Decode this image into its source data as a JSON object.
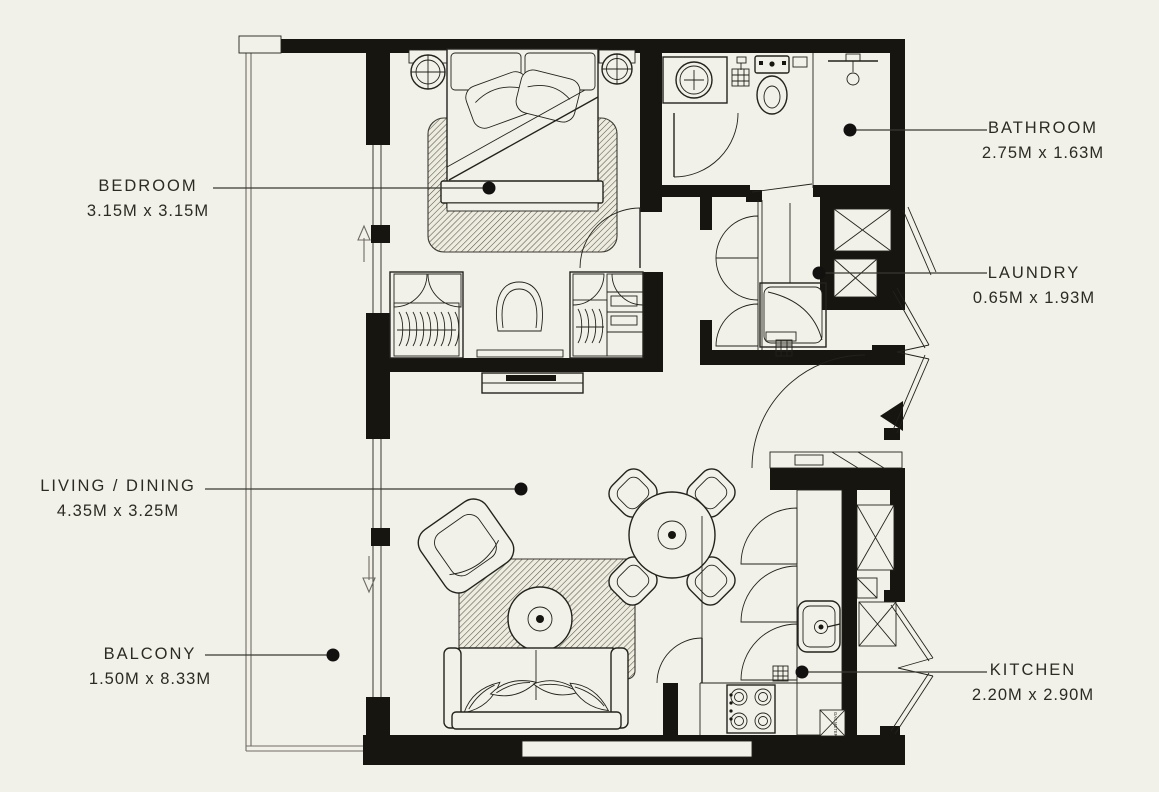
{
  "canvas": {
    "background_color": "#f2f1e9",
    "wall_color": "#16150f",
    "line_color": "#23221c",
    "label_text_color": "#2b2a23",
    "leader_line_color": "#3a3831"
  },
  "rooms": [
    {
      "key": "bedroom",
      "name": "BEDROOM",
      "dims": "3.15M x 3.15M",
      "label_side": "left"
    },
    {
      "key": "bathroom",
      "name": "BATHROOM",
      "dims": "2.75M x 1.63M",
      "label_side": "right"
    },
    {
      "key": "laundry",
      "name": "LAUNDRY",
      "dims": "0.65M x 1.93M",
      "label_side": "right"
    },
    {
      "key": "living_dining",
      "name": "LIVING / DINING",
      "dims": "4.35M x 3.25M",
      "label_side": "left"
    },
    {
      "key": "balcony",
      "name": "BALCONY",
      "dims": "1.50M x 8.33M",
      "label_side": "left"
    },
    {
      "key": "kitchen",
      "name": "KITCHEN",
      "dims": "2.20M x 2.90M",
      "label_side": "right"
    }
  ],
  "annotations": {
    "gas_meter": "GAS METER"
  },
  "fixture_icons": [
    "double-bed",
    "bedside-lamp",
    "bedroom-rug",
    "wardrobe-hanging",
    "wardrobe-shelves",
    "dressing-chair",
    "tv-console",
    "bathroom-sink",
    "toilet",
    "shower-head",
    "floor-drain",
    "washing-machine",
    "duct-shaft",
    "dining-table",
    "dining-chair",
    "coffee-table",
    "armchair",
    "sofa",
    "kitchen-sink",
    "gas-stove",
    "entry-door-swing",
    "sliding-door-arrow",
    "gas-meter-box"
  ]
}
